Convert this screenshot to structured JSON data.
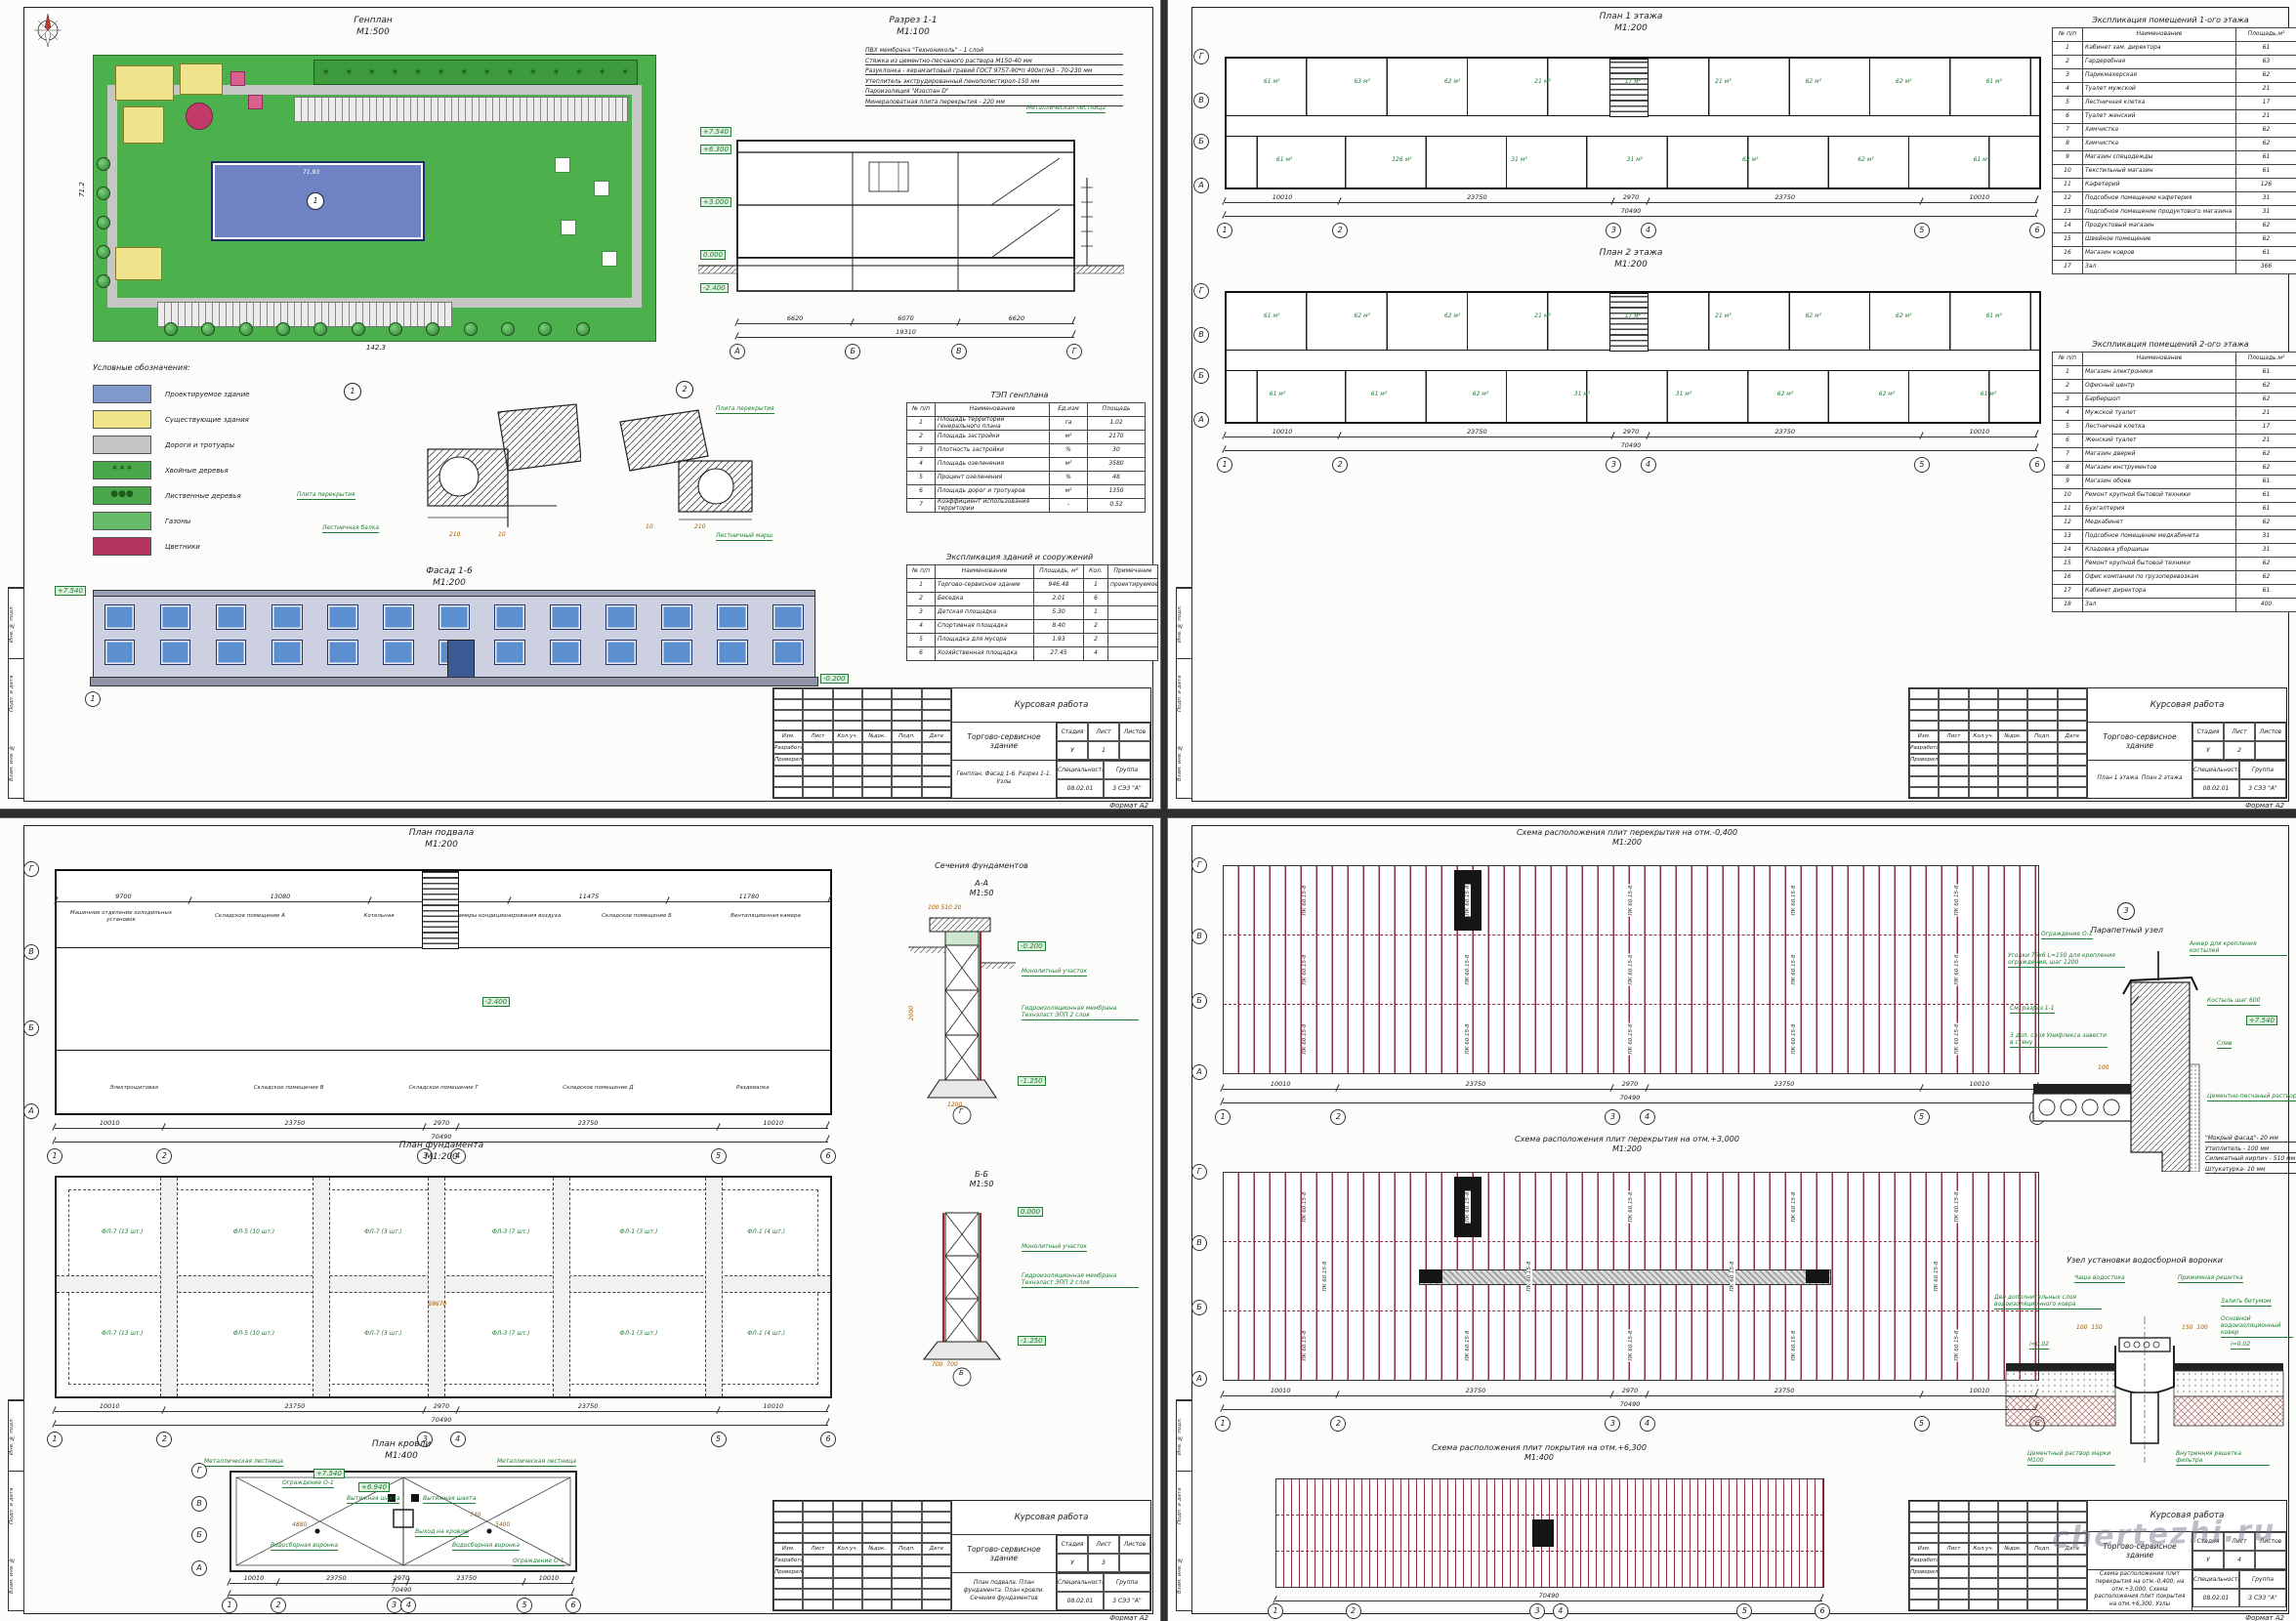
{
  "watermark": "chertezhi.ru",
  "titleblock": {
    "head_labels": [
      "Изм.",
      "Лист",
      "Кол.уч.",
      "№док.",
      "Подп.",
      "Дата"
    ],
    "dev_label": "Разработал",
    "check_label": "Проверил",
    "project": "Курсовая работа",
    "object": "Торгово-сервисное здание",
    "stage_label": "Стадия",
    "sheet_label": "Лист",
    "sheets_label": "Листов",
    "stage": "У",
    "spec_label": "Специальность",
    "group_label": "Группа",
    "spec": "08.02.01",
    "group": "3 СЭЗ \"А\"",
    "format": "Формат А2",
    "side_labels": [
      "Инв. № подл.",
      "Подп. и дата",
      "Взам. инв. №"
    ]
  },
  "sheet1": {
    "tb": {
      "content": "Генплан. Фасад 1-6. Разрез 1-1. Узлы",
      "sheet": "1"
    },
    "genplan": {
      "title": "Генплан",
      "scale": "М1:500",
      "dim_bottom": "142.3",
      "dim_left": "71.2",
      "building_no": "1",
      "building_dim": "71,93"
    },
    "razrez": {
      "title": "Разрез 1-1",
      "scale": "М1:100",
      "notes": [
        "ПВХ мембрана \"Технониколь\" - 1 слой",
        "Стяжка из цементно-песчаного раствора М150-40 мм",
        "Разуклонка - керамзитовый гравий ГОСТ 9757-90*п 400кг/м3 - 70-230 мм",
        "Утеплитель экструдированный пенополистирол-150 мм",
        "Пароизоляция \"Изоспан D\"",
        "Минераловатная плита перекрытия - 220 мм"
      ],
      "ladder": "Металлическая лестница",
      "elevations": [
        "+7.540",
        "+6.300",
        "+3.000",
        "0.000",
        "-2.400"
      ],
      "dims": [
        "6620",
        "6070",
        "6620"
      ],
      "total": "19310",
      "axes": [
        "А",
        "Б",
        "В",
        "Г"
      ]
    },
    "legend": {
      "title": "Условные обозначения:",
      "items": [
        {
          "label": "Проектируемое здание",
          "color": "#8099cc",
          "type": "new"
        },
        {
          "label": "Существующие здания",
          "color": "#f0e48a",
          "type": "old"
        },
        {
          "label": "Дороги и тротуары",
          "color": "#c4c4c4",
          "type": "road"
        },
        {
          "label": "Хвойные деревья",
          "color": "#4aa84a",
          "type": "conifer"
        },
        {
          "label": "Лиственные деревья",
          "color": "#4aa84a",
          "type": "tree"
        },
        {
          "label": "Газоны",
          "color": "#66bb66",
          "type": "lawn"
        },
        {
          "label": "Цветники",
          "color": "#b5355f",
          "type": "flower"
        }
      ]
    },
    "details": {
      "d1_num": "1",
      "d2_num": "2",
      "slab": "Плита перекрытия",
      "beam": "Лестничная балка",
      "march": "Лестничный марш",
      "dim210": "210",
      "dim10": "10"
    },
    "tep": {
      "title": "ТЭП генплана",
      "headers": [
        "№ п/п",
        "Наименование",
        "Ед.изм",
        "Площадь"
      ],
      "rows": [
        [
          "1",
          "Площадь территории генерального плана",
          "га",
          "1.02"
        ],
        [
          "2",
          "Площадь застройки",
          "м²",
          "2170"
        ],
        [
          "3",
          "Плотность застройки",
          "%",
          "30"
        ],
        [
          "4",
          "Площадь озеленения",
          "м²",
          "3580"
        ],
        [
          "5",
          "Процент озеленения",
          "%",
          "48"
        ],
        [
          "6",
          "Площадь дорог и тротуаров",
          "м²",
          "1350"
        ],
        [
          "7",
          "Коэффициент использования территории",
          "-",
          "0.52"
        ]
      ]
    },
    "fasad": {
      "title": "Фасад 1-6",
      "scale": "М1:200",
      "elev_top": "+7.540",
      "elev_bottom": "-0.200",
      "axis_l": "1",
      "axis_r": "6"
    },
    "expl_bld": {
      "title": "Экспликация зданий и сооружений",
      "headers": [
        "№ п/п",
        "Наименование",
        "Площадь, м²",
        "Кол.",
        "Примечание"
      ],
      "rows": [
        [
          "1",
          "Торгово-сервисное здание",
          "946.48",
          "1",
          "проектируемое"
        ],
        [
          "2",
          "Беседка",
          "2.01",
          "6",
          ""
        ],
        [
          "3",
          "Детская площадка",
          "5.30",
          "1",
          ""
        ],
        [
          "4",
          "Спортивная площадка",
          "8.40",
          "2",
          ""
        ],
        [
          "5",
          "Площадка для мусора",
          "1.93",
          "2",
          ""
        ],
        [
          "6",
          "Хозяйственная площадка",
          "27.45",
          "4",
          ""
        ]
      ]
    }
  },
  "sheet2": {
    "tb": {
      "content": "План 1 этажа. План 2 этажа",
      "sheet": "2"
    },
    "plan1": {
      "title": "План 1 этажа",
      "scale": "М1:200",
      "areas_top": [
        "61 м²",
        "63 м²",
        "62 м²",
        "21 м²",
        "17 м²",
        "21 м²",
        "62 м²",
        "62 м²",
        "61 м²"
      ],
      "areas_bottom": [
        "61 м²",
        "126 м²",
        "31 м²",
        "31 м²",
        "62 м²",
        "62 м²",
        "61 м²"
      ]
    },
    "plan2": {
      "title": "План 2 этажа",
      "scale": "М1:200",
      "areas_top": [
        "61 м²",
        "62 м²",
        "62 м²",
        "21 м²",
        "17 м²",
        "21 м²",
        "62 м²",
        "62 м²",
        "61 м²"
      ],
      "areas_bottom": [
        "61 м²",
        "61 м²",
        "62 м²",
        "31 м²",
        "31 м²",
        "62 м²",
        "62 м²",
        "61 м²"
      ]
    },
    "dims": [
      "10010",
      "23750",
      "2970",
      "23750",
      "10010"
    ],
    "total": "70490",
    "axes_h": [
      "1",
      "2",
      "3",
      "4",
      "5",
      "6"
    ],
    "axes_v": [
      "Г",
      "В",
      "Б",
      "А"
    ],
    "dims_v": [
      "6620",
      "6070",
      "6620"
    ],
    "expl1": {
      "title": "Экспликация помещений 1-ого этажа",
      "headers": [
        "№ п/п",
        "Наименование",
        "Площадь,м²"
      ],
      "rows": [
        [
          "1",
          "Кабинет зам. директора",
          "61"
        ],
        [
          "2",
          "Гардеробная",
          "63"
        ],
        [
          "3",
          "Парикмахерская",
          "62"
        ],
        [
          "4",
          "Туалет мужской",
          "21"
        ],
        [
          "5",
          "Лестничная клетка",
          "17"
        ],
        [
          "6",
          "Туалет женский",
          "21"
        ],
        [
          "7",
          "Химчистка",
          "62"
        ],
        [
          "8",
          "Химчистка",
          "62"
        ],
        [
          "9",
          "Магазин спецодежды",
          "61"
        ],
        [
          "10",
          "Текстильный магазин",
          "61"
        ],
        [
          "11",
          "Кафетерий",
          "126"
        ],
        [
          "12",
          "Подсобное помещение кафетерия",
          "31"
        ],
        [
          "13",
          "Подсобное помещение продуктового магазина",
          "31"
        ],
        [
          "14",
          "Продуктовый магазин",
          "62"
        ],
        [
          "15",
          "Швейное помещение",
          "62"
        ],
        [
          "16",
          "Магазин ковров",
          "61"
        ],
        [
          "17",
          "Зал",
          "366"
        ]
      ]
    },
    "expl2": {
      "title": "Экспликация помещений 2-ого этажа",
      "headers": [
        "№ п/п",
        "Наименование",
        "Площадь,м²"
      ],
      "rows": [
        [
          "1",
          "Магазин электроники",
          "61"
        ],
        [
          "2",
          "Офисный центр",
          "62"
        ],
        [
          "3",
          "Барбершоп",
          "62"
        ],
        [
          "4",
          "Мужской туалет",
          "21"
        ],
        [
          "5",
          "Лестничная клетка",
          "17"
        ],
        [
          "6",
          "Женский туалет",
          "21"
        ],
        [
          "7",
          "Магазин дверей",
          "62"
        ],
        [
          "8",
          "Магазин инструментов",
          "62"
        ],
        [
          "9",
          "Магазин обоев",
          "61"
        ],
        [
          "10",
          "Ремонт крупной бытовой техники",
          "61"
        ],
        [
          "11",
          "Бухгалтерия",
          "61"
        ],
        [
          "12",
          "Медкабинет",
          "62"
        ],
        [
          "13",
          "Подсобное помещение медкабинета",
          "31"
        ],
        [
          "14",
          "Кладовка уборщицы",
          "31"
        ],
        [
          "15",
          "Ремонт крупной бытовой техники",
          "62"
        ],
        [
          "16",
          "Офис компании по грузоперевозкам",
          "62"
        ],
        [
          "17",
          "Кабинет директора",
          "61"
        ],
        [
          "18",
          "Зал",
          "400"
        ]
      ]
    }
  },
  "sheet3": {
    "tb": {
      "content": "План подвала. План фундамента. План кровли. Сечения фундаментов",
      "sheet": "3"
    },
    "podval": {
      "title": "План подвала",
      "scale": "М1:200",
      "elev": "-2.400",
      "rooms_top": [
        "Машинное отделение холодильных установок",
        "Складское помещение А",
        "Котельная",
        "Камеры кондиционирования воздуха",
        "Складское помещение Б",
        "Вентиляционная камера"
      ],
      "rooms_bottom": [
        "Электрощитовая",
        "Складское помещение В",
        "Складское помещение Г",
        "Складское помещение Д",
        "Раздевалка"
      ],
      "dims_top": [
        "9700",
        "13080",
        "10135",
        "11475",
        "11780"
      ]
    },
    "fundament": {
      "title": "План фундамента",
      "scale": "М1:200",
      "pads": [
        "ФЛ-7 (13 шт.)",
        "ФЛ-5 (10 шт.)",
        "ФЛ-7 (3 шт.)",
        "ФЛ-3 (7 шт.)",
        "ФЛ-1 (3 шт.)",
        "ФЛ-1 (4 шт.)"
      ],
      "dim_inner": "69670"
    },
    "sections": {
      "group_title": "Сечения фундаментов",
      "a": {
        "name": "А-А",
        "scale": "М1:50",
        "monolith": "Монолитный участок",
        "membrane": "Гидроизоляционная мембрана Технэласт ЭПП 2 слоя",
        "elev1": "-0.200",
        "elev2": "-1.250",
        "dims_top": [
          "100",
          "510",
          "20"
        ],
        "dim_h": "2000",
        "dim_w": "1200",
        "axis": "Г"
      },
      "b": {
        "name": "Б-Б",
        "scale": "М1:50",
        "monolith": "Монолитный участок",
        "membrane": "Гидроизоляционная мембрана Технэласт ЭПП 2 слоя",
        "elev1": "0.000",
        "elev2": "-1.250",
        "dims_bot": [
          "700",
          "700"
        ],
        "axis": "Б"
      }
    },
    "krovlya": {
      "title": "План кровли",
      "scale": "М1:400",
      "ladder": "Металлическая лестница",
      "fence": "Ограждение О-1",
      "shaft": "Вытяжная шахта",
      "exit": "Выход на кровлю",
      "funnel": "Водосборная воронка",
      "elev1": "+7.540",
      "elev2": "+6.940",
      "dim1": "4880",
      "dim2": "5400",
      "dim3": "740"
    },
    "dims": [
      "10010",
      "23750",
      "2970",
      "23750",
      "10010"
    ],
    "total": "70490",
    "axes_h": [
      "1",
      "2",
      "3",
      "4",
      "5",
      "6"
    ],
    "axes_v": [
      "Г",
      "В",
      "Б",
      "А"
    ]
  },
  "sheet4": {
    "tb": {
      "content": "Схема расположения плит перекрытия на отм.-0,400; на отм.+3,000. Схема расположения плит покрытия на отм.+6,300. Узлы",
      "sheet": "4"
    },
    "scheme1": {
      "title": "Схема расположения плит перекрытия на отм.-0,400",
      "scale": "М1:200",
      "plate": "ПК 60.15-8",
      "plate2": "ПК8.12-8"
    },
    "scheme2": {
      "title": "Схема расположения плит перекрытия на отм.+3,000",
      "scale": "М1:200",
      "plate": "ПК 60.15-8",
      "plate2": "ПК8.12-8"
    },
    "scheme3": {
      "title": "Схема расположения плит покрытия на отм.+6,300",
      "scale": "М1:400"
    },
    "dims": [
      "10010",
      "23750",
      "2970",
      "23750",
      "10010"
    ],
    "total": "70490",
    "axes_h": [
      "1",
      "2",
      "3",
      "4",
      "5",
      "6"
    ],
    "axes_v": [
      "Г",
      "В",
      "Б",
      "А"
    ],
    "dims_v": [
      "6620",
      "6070",
      "6620"
    ],
    "parapet": {
      "num": "3",
      "title": "Парапетный узел",
      "fence": "Ограждение О-1",
      "angles": "Уголки 75x6 L=150 для крепления ограждения, шаг 1200",
      "anchor": "Анкер для крепления костылей",
      "kostyl": "Костыль шаг 600",
      "elev": "+7.540",
      "sliv": "Слив",
      "see": "См. разрез 1-1",
      "uniflex": "3 доп. слоя Унифлекса завести в стену",
      "mortar": "Цементно-песчаный раствор",
      "dim": "100",
      "layers": [
        "\"Мокрый фасад\"- 20 мм",
        "Утеплитель - 100 мм",
        "Силикатный кирпич - 510 мм",
        "Штукатурка- 10 мм"
      ]
    },
    "voronka": {
      "title": "Узел установки водосборной воронки",
      "extra": "Два дополнительных слоя водоизоляционного ковра",
      "cup": "Чаша водостока",
      "grate": "Прижимная решетка",
      "bitum": "Залить битумом",
      "main": "Основной водоизоляционный ковер",
      "mortar": "Цементный раствор марки М100",
      "filter": "Внутренняя решетка фильтра",
      "dims": [
        "100",
        "150",
        "150",
        "100"
      ],
      "slope": "i=0.02"
    }
  }
}
